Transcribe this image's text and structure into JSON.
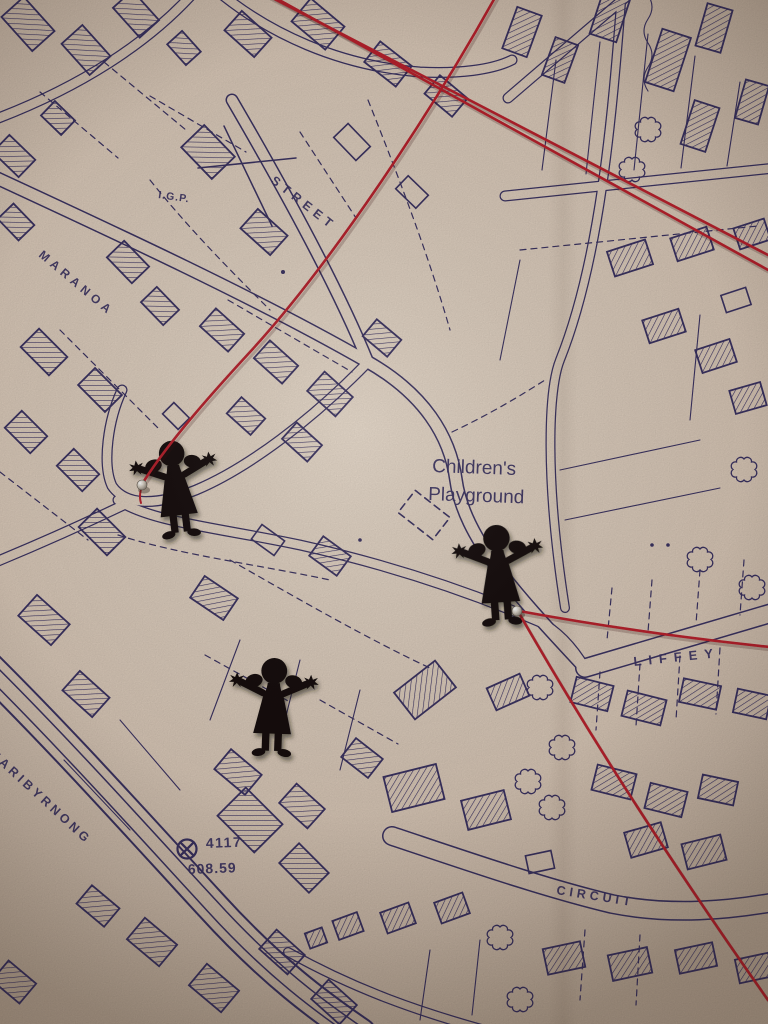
{
  "map": {
    "street_labels": {
      "maranoa": "MARANOA",
      "street": "STREET",
      "maribyrnong": "MARIBYRNONG",
      "liffey": "LIFFEY",
      "circuit": "CIRCUIT"
    },
    "annotations": {
      "igp": "I.G.P."
    },
    "playground": {
      "line1": "Children's",
      "line2": "Playground"
    },
    "survey": {
      "lot_number": "4117",
      "elevation": "608.59"
    },
    "symbols": {
      "benchmark": "circled-cross-benchmark",
      "crosshair": "survey-crosshair",
      "tree": "scalloped-tree-outline"
    }
  },
  "overlay": {
    "figures": [
      {
        "name": "girl-cutout-left",
        "pinned": true
      },
      {
        "name": "girl-cutout-middle",
        "pinned": false
      },
      {
        "name": "girl-cutout-right",
        "pinned": true
      }
    ],
    "threads": {
      "count": 4
    },
    "pins": {
      "count": 2
    }
  },
  "colors": {
    "paper": "#d8c8b8",
    "ink": "#3a3260",
    "thread": "#b6212c",
    "figure": "#14110f",
    "pin": "#d6cec2"
  }
}
